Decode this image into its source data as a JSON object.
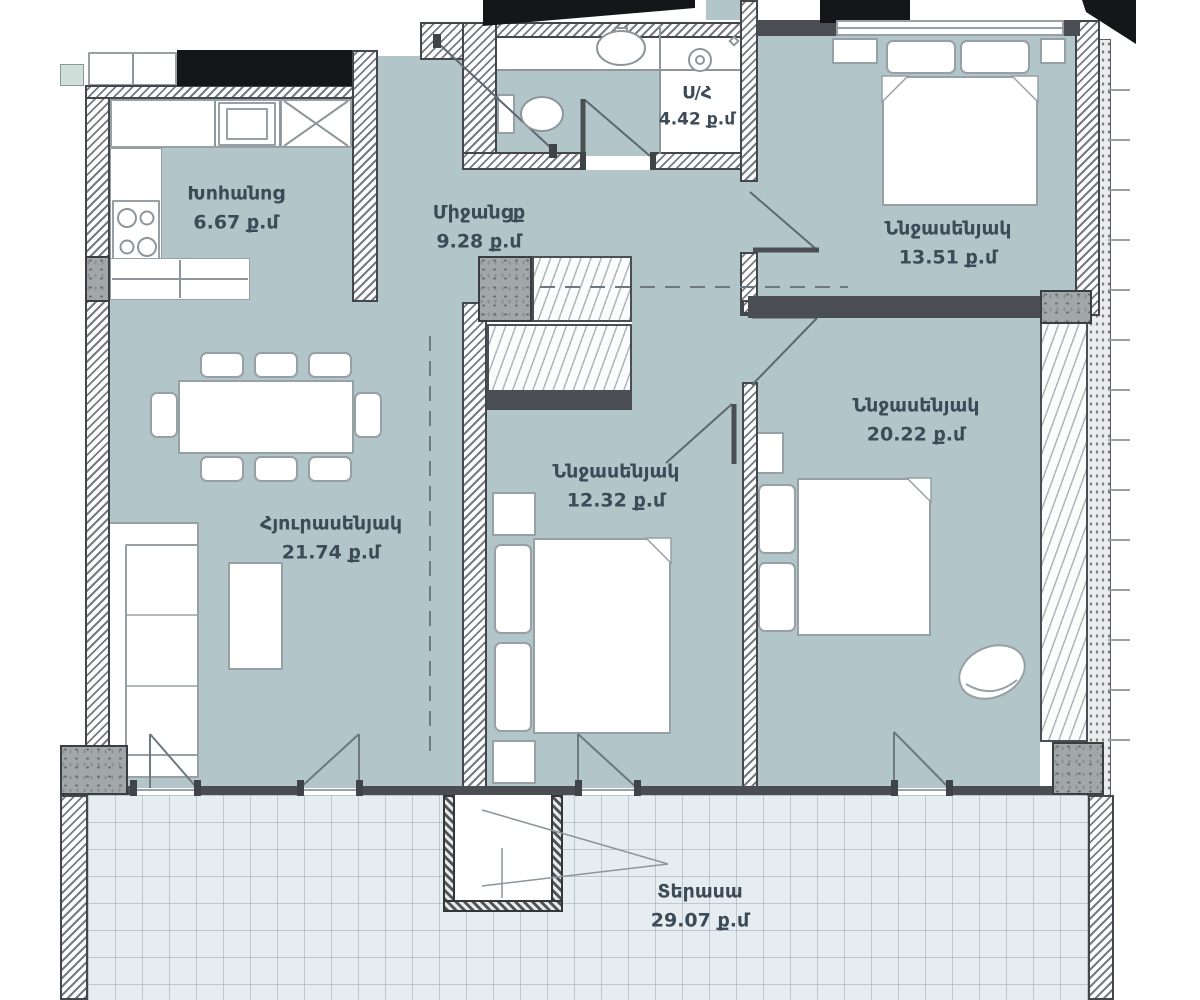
{
  "plan": {
    "area_unit": "ք.մ",
    "rooms": {
      "kitchen": {
        "name": "Խոհանոց",
        "area": "6.67 ք.մ"
      },
      "corridor": {
        "name": "Միջանցք",
        "area": "9.28 ք.մ"
      },
      "bathroom": {
        "name": "Ս/Հ",
        "area": "4.42 ք.մ"
      },
      "bedroom_top": {
        "name": "Ննջասենյակ",
        "area": "13.51 ք.մ"
      },
      "bedroom_right": {
        "name": "Ննջասենյակ",
        "area": "20.22 ք.մ"
      },
      "bedroom_middle": {
        "name": "Ննջասենյակ",
        "area": "12.32 ք.մ"
      },
      "living_room": {
        "name": "Հյուրասենյակ",
        "area": "21.74 ք.մ"
      },
      "terrace": {
        "name": "Տերասա",
        "area": "29.07 ք.մ"
      }
    },
    "colors": {
      "room_fill": "#b2c5c8",
      "terrace_fill": "#e6edf0",
      "label_text": "#3d4b58",
      "wall_dark": "#4a4e52"
    }
  }
}
